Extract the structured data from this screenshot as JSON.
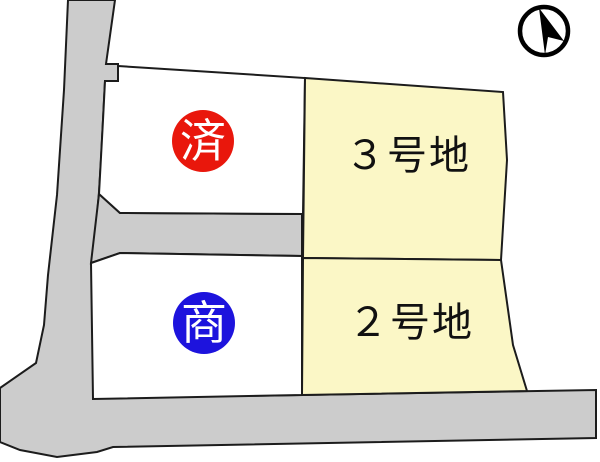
{
  "colors": {
    "background": "#ffffff",
    "road": "#cccccc",
    "outline": "#1c1c1c",
    "lot_white": "#ffffff",
    "lot_yellow": "#fbf7c6",
    "sold_badge": "#e9170c",
    "negotiation_badge": "#1d13dd",
    "badge_text": "#ffffff",
    "label_text": "#111111"
  },
  "lots": {
    "top_left": {
      "badge": "済"
    },
    "lot3": {
      "label": "３号地"
    },
    "bottom_left": {
      "badge": "商"
    },
    "lot2": {
      "label": "２号地"
    }
  },
  "compass": {
    "icon": "north-arrow"
  }
}
